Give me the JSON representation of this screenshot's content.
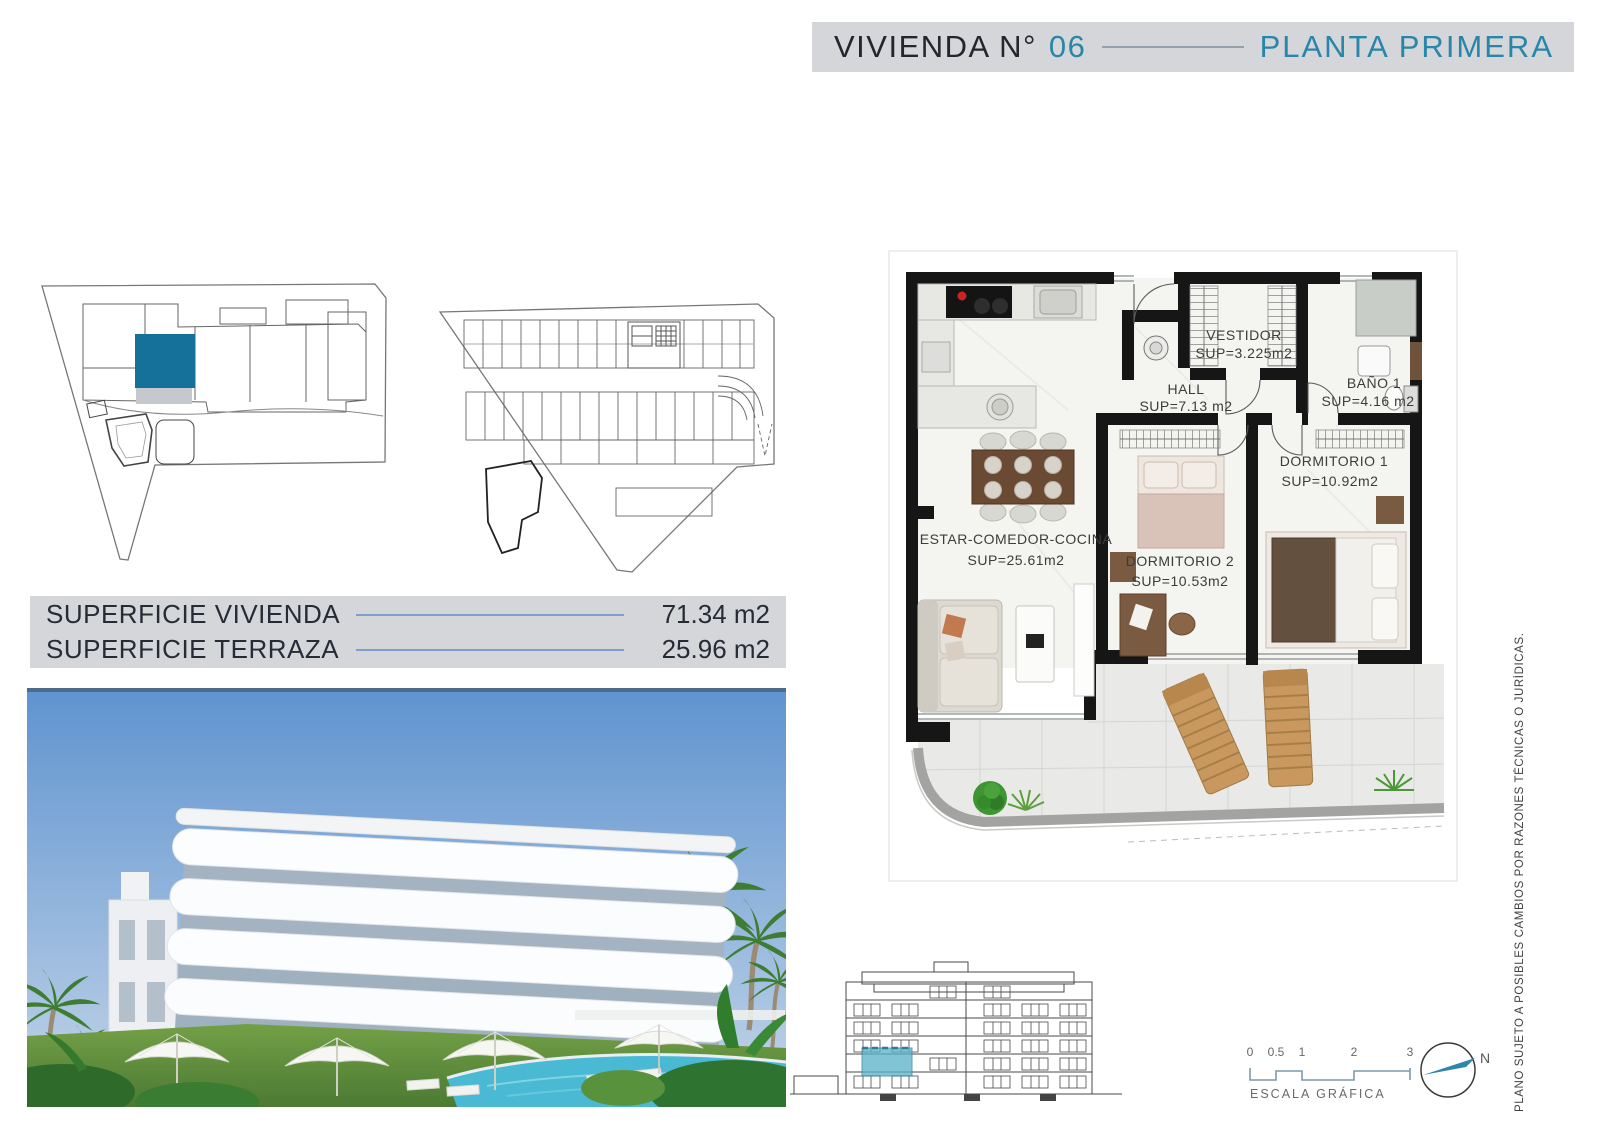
{
  "header": {
    "title_left": "VIVIENDA N°",
    "title_number": "06",
    "title_right": "PLANTA PRIMERA"
  },
  "surfaces": {
    "rows": [
      {
        "label": "SUPERFICIE VIVIENDA",
        "value": "71.34 m2"
      },
      {
        "label": "SUPERFICIE TERRAZA",
        "value": "25.96 m2"
      }
    ]
  },
  "floorplan": {
    "rooms": [
      {
        "name": "VESTIDOR",
        "sup": "SUP=3.225m2"
      },
      {
        "name": "HALL",
        "sup": "SUP=7.13 m2"
      },
      {
        "name": "BAÑO 1",
        "sup": "SUP=4.16 m2"
      },
      {
        "name": "DORMITORIO 1",
        "sup": "SUP=10.92m2"
      },
      {
        "name": "DORMITORIO 2",
        "sup": "SUP=10.53m2"
      },
      {
        "name": "ESTAR-COMEDOR-COCINA",
        "sup": "SUP=25.61m2"
      }
    ]
  },
  "footer": {
    "scale_ticks": [
      "0",
      "0.5",
      "1",
      "2",
      "3"
    ],
    "scale_label": "ESCALA GRÁFICA",
    "north_label": "N"
  },
  "disclaimer": "PLANO SUJETO A POSIBLES CAMBIOS POR RAZONES TÉCNICAS O JURÍDICAS.",
  "colors": {
    "teal_accent": "#2a86a8",
    "unit_fill": "#16719a",
    "elevation_highlight": "#58b1c9",
    "panel_gray": "#d5d6da"
  }
}
